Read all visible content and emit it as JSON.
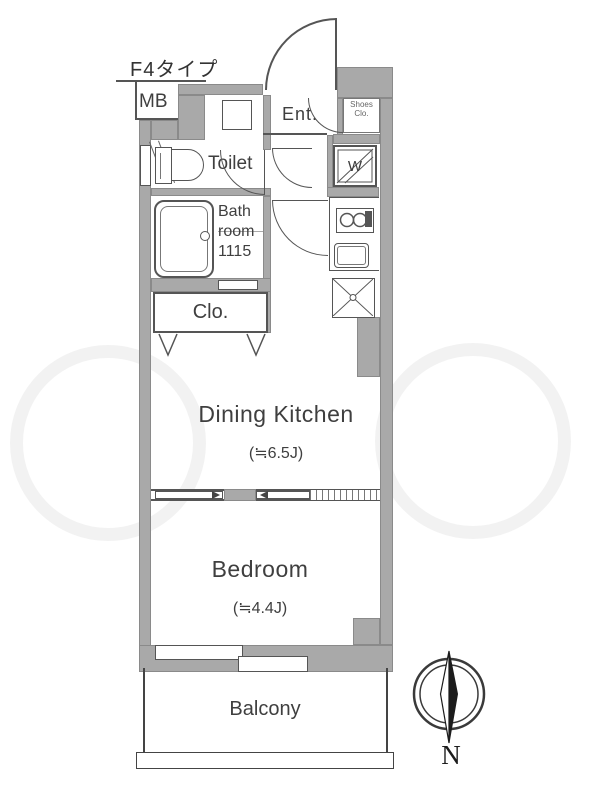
{
  "plan": {
    "title": "F4タイプ",
    "unit": {
      "mb": "MB",
      "entrance": "Ent.",
      "shoes_closet": {
        "line1": "Shoes",
        "line2": "Clo."
      },
      "toilet": "Toilet",
      "washer": "W",
      "bathroom": {
        "line1": "Bath",
        "line2": "room",
        "line3": "1115"
      },
      "closet": "Clo.",
      "dining_kitchen": {
        "name": "Dining Kitchen",
        "size": "(≒6.5J)"
      },
      "bedroom": {
        "name": "Bedroom",
        "size": "(≒4.4J)"
      },
      "balcony": "Balcony"
    },
    "compass": {
      "north": "N"
    },
    "colors": {
      "wall": "#a9a9a9",
      "line": "#555555",
      "text": "#3f3f3f"
    }
  }
}
